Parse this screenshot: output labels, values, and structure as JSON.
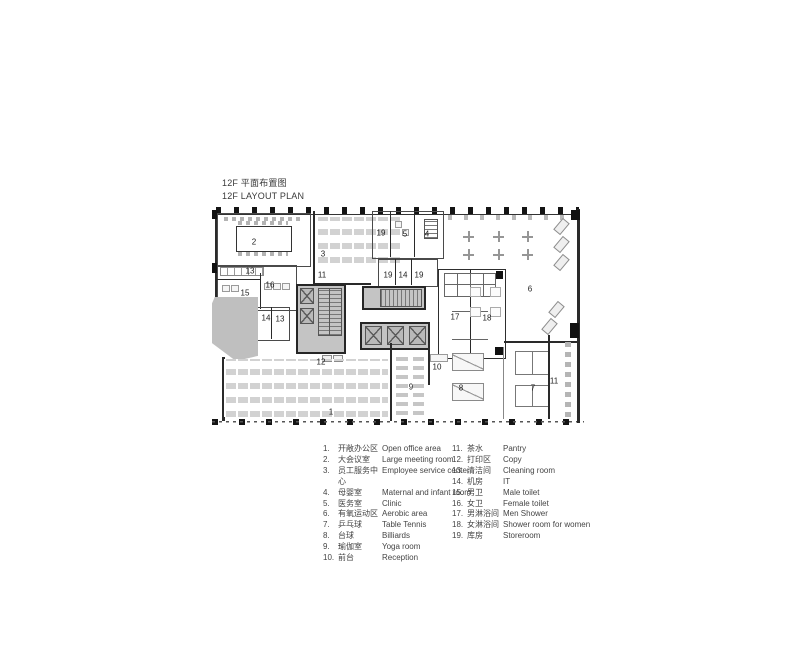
{
  "title": {
    "zh": "12F 平面布置图",
    "en": "12F LAYOUT PLAN"
  },
  "colors": {
    "wall": "#2a2a2a",
    "core_fill": "#c4c4c4",
    "column": "#111111",
    "text": "#3d3d3d"
  },
  "plan": {
    "nums": {
      "n1": "1",
      "n2": "2",
      "n3": "3",
      "n4": "4",
      "n5": "5",
      "n6": "6",
      "n7": "7",
      "n8": "8",
      "n9": "9",
      "n10": "10",
      "n11": "11",
      "n12": "12",
      "n13": "13",
      "n14": "14",
      "n15": "15",
      "n16": "16",
      "n17": "17",
      "n18": "18",
      "n19": "19"
    }
  },
  "legend": {
    "items": [
      {
        "num": "1.",
        "zh": "开敞办公区",
        "en": "Open office area"
      },
      {
        "num": "2.",
        "zh": "大会议室",
        "en": "Large meeting room"
      },
      {
        "num": "3.",
        "zh": "员工服务中心",
        "en": "Employee service center"
      },
      {
        "num": "4.",
        "zh": "母婴室",
        "en": "Maternal and infant room"
      },
      {
        "num": "5.",
        "zh": "医务室",
        "en": "Clinic"
      },
      {
        "num": "6.",
        "zh": "有氧运动区",
        "en": "Aerobic area"
      },
      {
        "num": "7.",
        "zh": "乒乓球",
        "en": "Table Tennis"
      },
      {
        "num": "8.",
        "zh": "台球",
        "en": "Billiards"
      },
      {
        "num": "9.",
        "zh": "瑜伽室",
        "en": "Yoga room"
      },
      {
        "num": "10.",
        "zh": "前台",
        "en": "Reception"
      },
      {
        "num": "11.",
        "zh": "茶水",
        "en": "Pantry"
      },
      {
        "num": "12.",
        "zh": "打印区",
        "en": "Copy"
      },
      {
        "num": "13.",
        "zh": "清洁间",
        "en": "Cleaning room"
      },
      {
        "num": "14.",
        "zh": "机房",
        "en": "IT"
      },
      {
        "num": "15.",
        "zh": "男卫",
        "en": "Male toilet"
      },
      {
        "num": "16.",
        "zh": "女卫",
        "en": "Female toilet"
      },
      {
        "num": "17.",
        "zh": "男淋浴间",
        "en": "Men Shower"
      },
      {
        "num": "18.",
        "zh": "女淋浴间",
        "en": "Shower room for women"
      },
      {
        "num": "19.",
        "zh": "库房",
        "en": "Storeroom"
      }
    ]
  }
}
